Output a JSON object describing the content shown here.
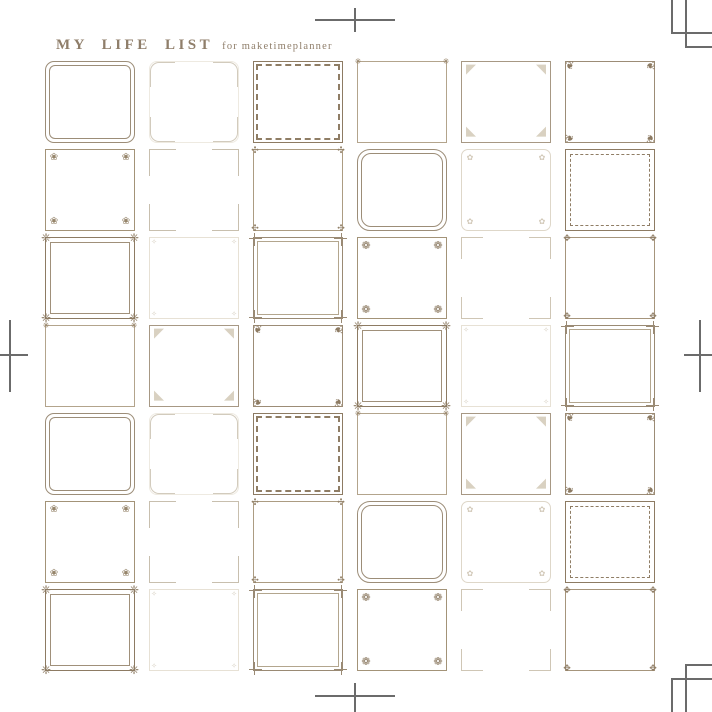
{
  "header": {
    "title": "MY LIFE LIST",
    "subtitle": "for maketimeplanner",
    "color": "#8f7e6a"
  },
  "palette": {
    "frame_dark": "#8d7b63",
    "frame_mid": "#a39378",
    "frame_light": "#c8bfae",
    "frame_faint": "#e7e1d5",
    "crop_mark": "#6b6b6b",
    "background": "#ffffff"
  },
  "frame_styles": [
    {
      "id": "A",
      "name": "rounded-chamfer-double"
    },
    {
      "id": "B",
      "name": "light-corner-brackets"
    },
    {
      "id": "C",
      "name": "dashed-double-dark"
    },
    {
      "id": "D",
      "name": "thin-star-corners"
    },
    {
      "id": "E",
      "name": "lace-triangle-corners"
    },
    {
      "id": "F",
      "name": "floral-curl-corners"
    },
    {
      "id": "G",
      "name": "fan-flower-corners"
    },
    {
      "id": "H",
      "name": "delicate-corner-brackets"
    },
    {
      "id": "I",
      "name": "knot-corners"
    },
    {
      "id": "J",
      "name": "rounded-double"
    },
    {
      "id": "K",
      "name": "faint-floral-corners"
    },
    {
      "id": "L",
      "name": "solid-dashed-inset"
    },
    {
      "id": "M",
      "name": "ornate-flourish"
    },
    {
      "id": "N",
      "name": "faint-dot-corners"
    },
    {
      "id": "O",
      "name": "crossing-line-corners"
    },
    {
      "id": "P",
      "name": "fan-corners-bold"
    },
    {
      "id": "Q",
      "name": "light-brackets"
    },
    {
      "id": "R",
      "name": "leaf-tick-corners"
    }
  ],
  "grid": {
    "rows": 7,
    "cols": 6,
    "cells": [
      "A",
      "B",
      "C",
      "D",
      "E",
      "F",
      "G",
      "H",
      "I",
      "J",
      "K",
      "L",
      "M",
      "N",
      "O",
      "P",
      "Q",
      "R",
      "D",
      "E",
      "F",
      "M",
      "N",
      "O",
      "A",
      "B",
      "C",
      "D",
      "E",
      "F",
      "G",
      "H",
      "I",
      "J",
      "K",
      "L",
      "M",
      "N",
      "O",
      "P",
      "Q",
      "R"
    ]
  },
  "crop_marks": [
    "top-center-cross",
    "top-right-corner-marks",
    "left-middle-cross",
    "right-middle-cross",
    "bottom-center-cross",
    "bottom-right-corner-marks"
  ]
}
